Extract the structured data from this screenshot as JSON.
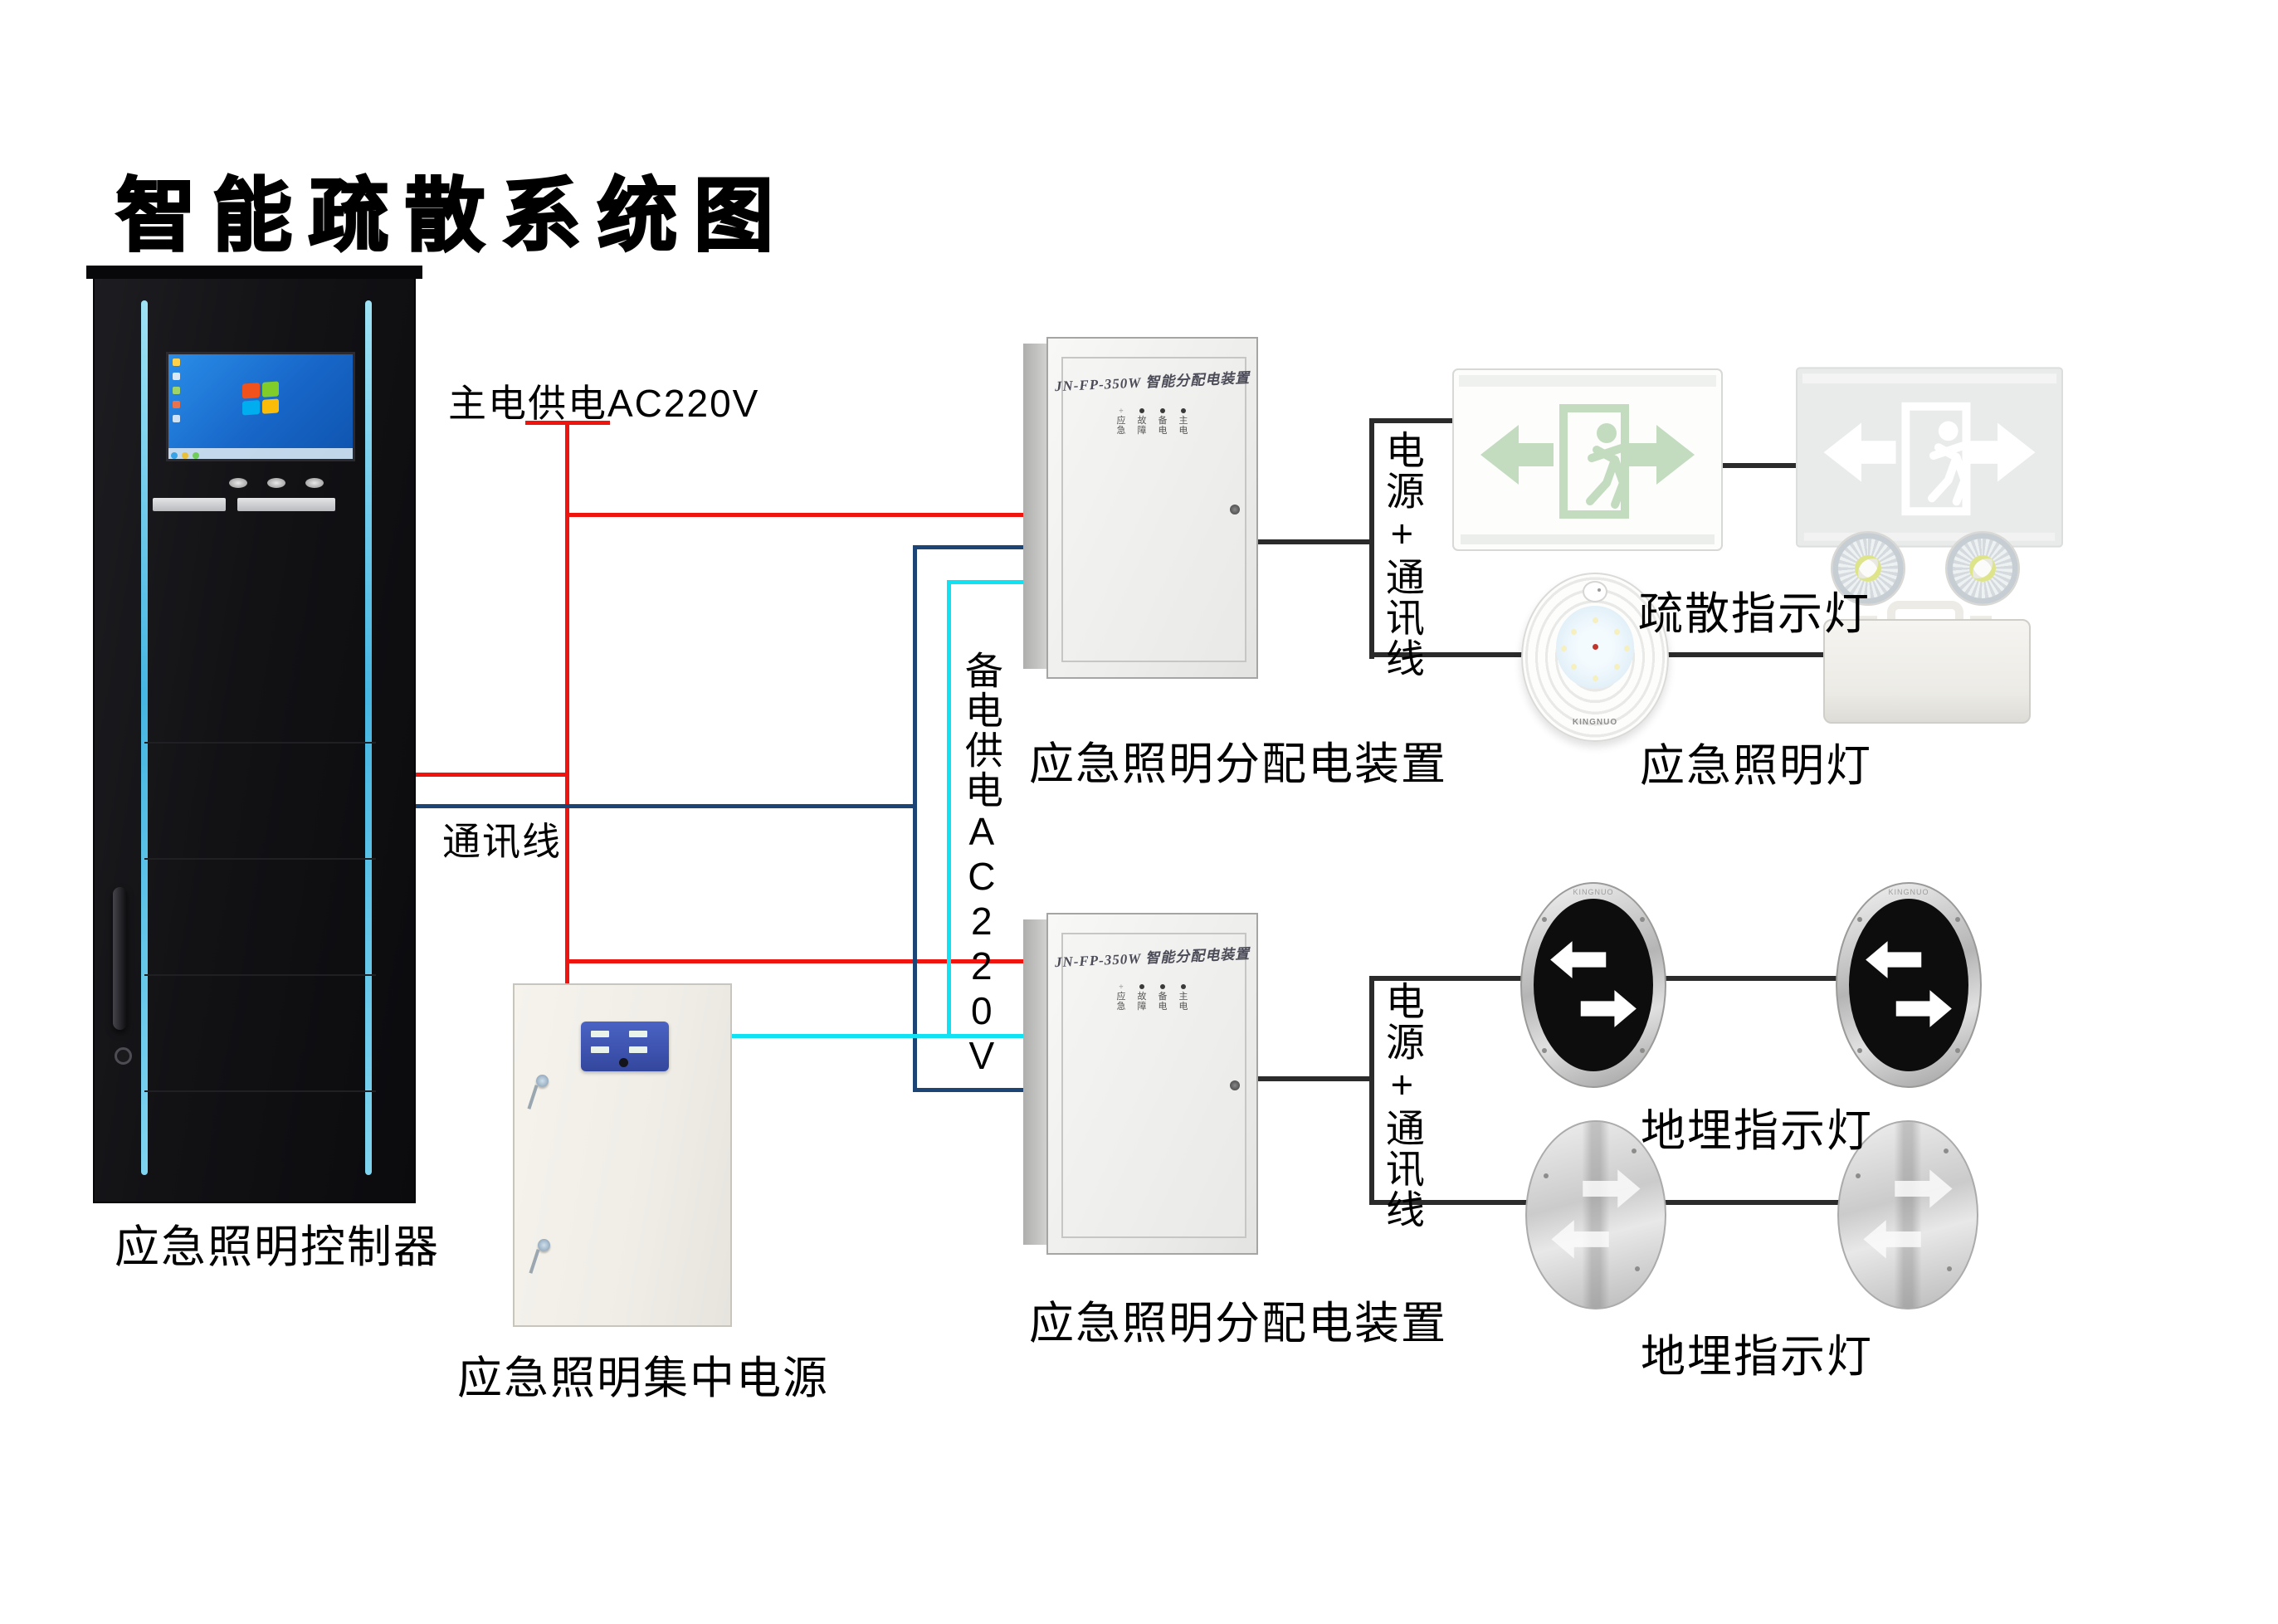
{
  "title": "智能疏散系统图",
  "colors": {
    "main_power_line": "#f0140f",
    "comm_line": "#1c4474",
    "backup_power_line": "#10e2f4",
    "device_link_line": "#2b2b2b",
    "rack_accent": "#4fc8ee",
    "panel_blue": "#3c55b4"
  },
  "devices": {
    "controller": {
      "label": "应急照明控制器"
    },
    "central_power": {
      "label": "应急照明集中电源"
    },
    "dist_box": {
      "panel_title": "JN-FP-350W 智能分配电装置",
      "label": "应急照明分配电装置",
      "led_symbol": "÷",
      "led_labels": [
        "应急",
        "故障",
        "备电",
        "主电"
      ]
    },
    "exit_sign": {
      "label": "疏散指示灯"
    },
    "emergency_lamp": {
      "label": "应急照明灯",
      "brand": "KINGNUO"
    },
    "ground_lamp": {
      "label": "地埋指示灯"
    }
  },
  "wires": {
    "main_power": "主电供电AC220V",
    "comm": "通讯线",
    "backup_power": "备电供电AC220V",
    "power_comm": "电源+通讯线"
  }
}
